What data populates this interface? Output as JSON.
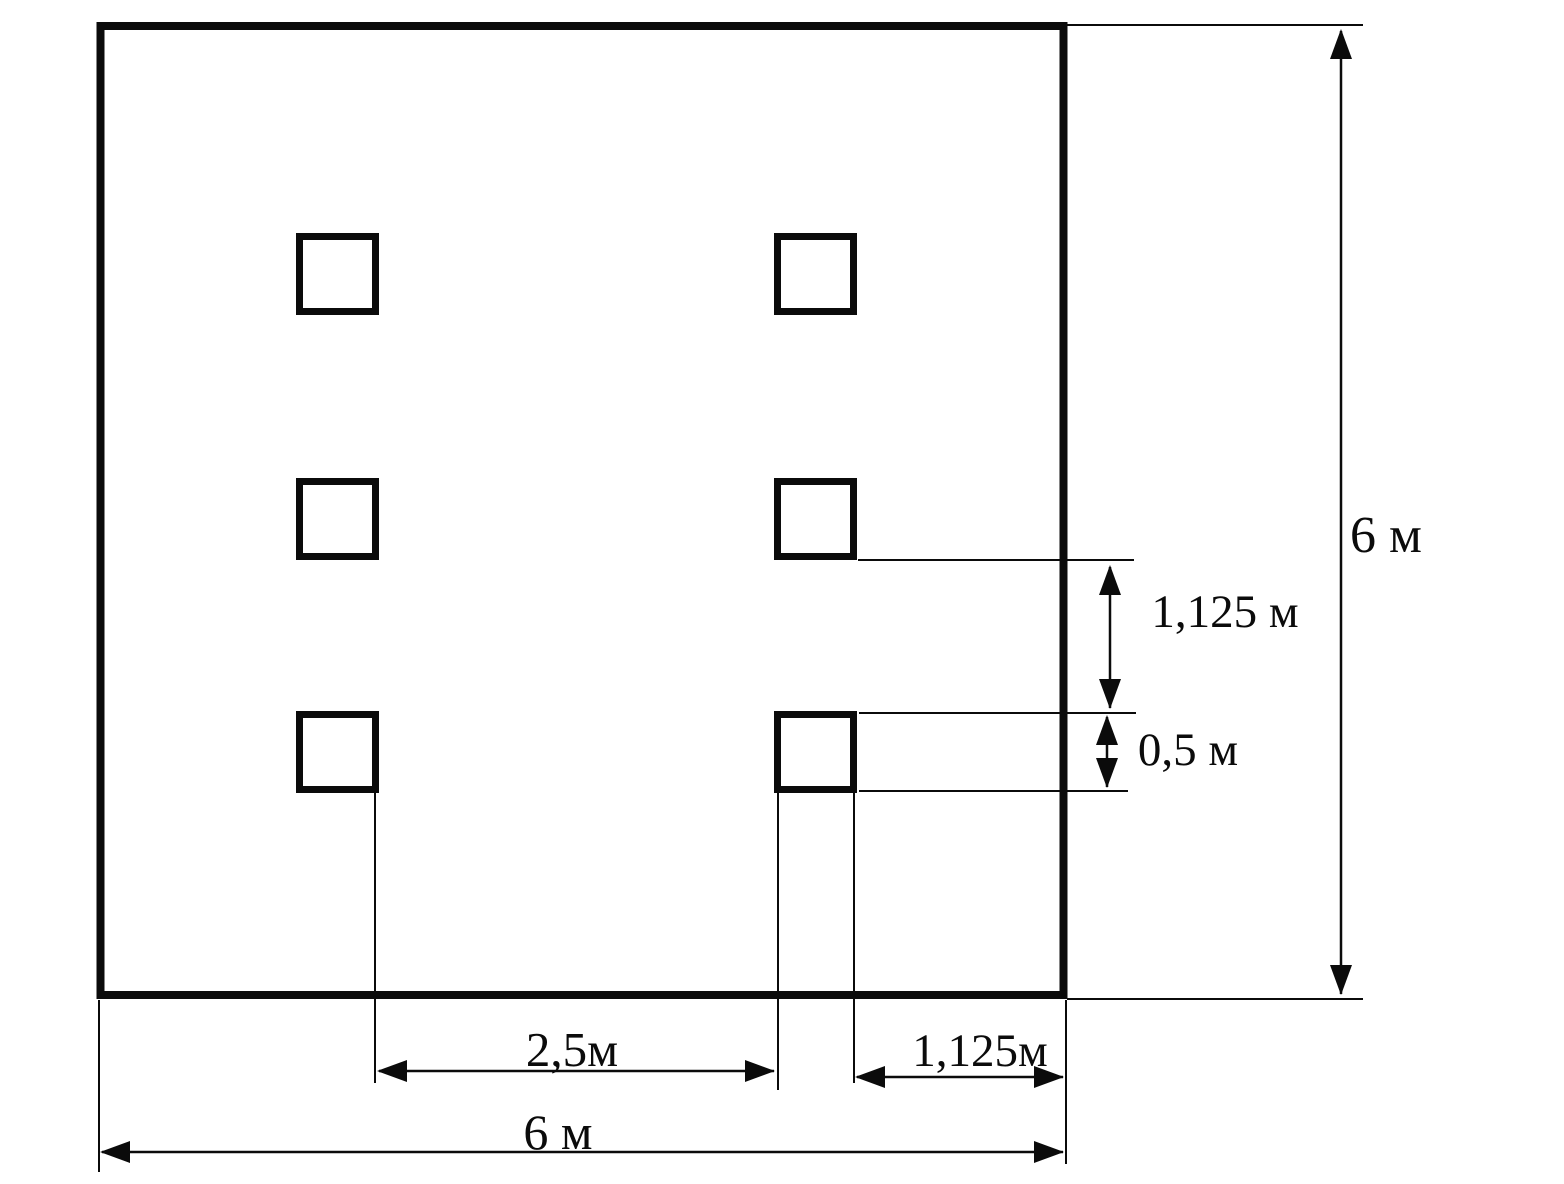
{
  "diagram": {
    "type": "technical-drawing",
    "description_visible_content": "square plan 6 m by 6 m with six square columns in two vertical rows of three",
    "units": "м",
    "labels": {
      "height_total": "6 м",
      "row_gap_vertical": "1,125 м",
      "column_size_vertical": "0,5 м",
      "column_gap_horizontal": "2,5м",
      "edge_offset_horizontal": "1,125м",
      "width_total": "6 м"
    },
    "dimensions": [
      {
        "value": "6",
        "unit": "м",
        "label": "6 м",
        "orientation": "vertical",
        "measures": "total height of plan outline"
      },
      {
        "value": "1,125",
        "unit": "м",
        "label": "1,125 м",
        "orientation": "vertical",
        "measures": "gap between middle and bottom column rows"
      },
      {
        "value": "0,5",
        "unit": "м",
        "label": "0,5 м",
        "orientation": "vertical",
        "measures": "side of one column square"
      },
      {
        "value": "2,5",
        "unit": "м",
        "label": "2,5м",
        "orientation": "horizontal",
        "measures": "clear gap between left and right column lines"
      },
      {
        "value": "1,125",
        "unit": "м",
        "label": "1,125м",
        "orientation": "horizontal",
        "measures": "offset from right column line to plan edge"
      },
      {
        "value": "6",
        "unit": "м",
        "label": "6 м",
        "orientation": "horizontal",
        "measures": "total width of plan outline"
      }
    ],
    "colors": {
      "line": "#0b0b0b",
      "background": "#ffffff"
    }
  }
}
